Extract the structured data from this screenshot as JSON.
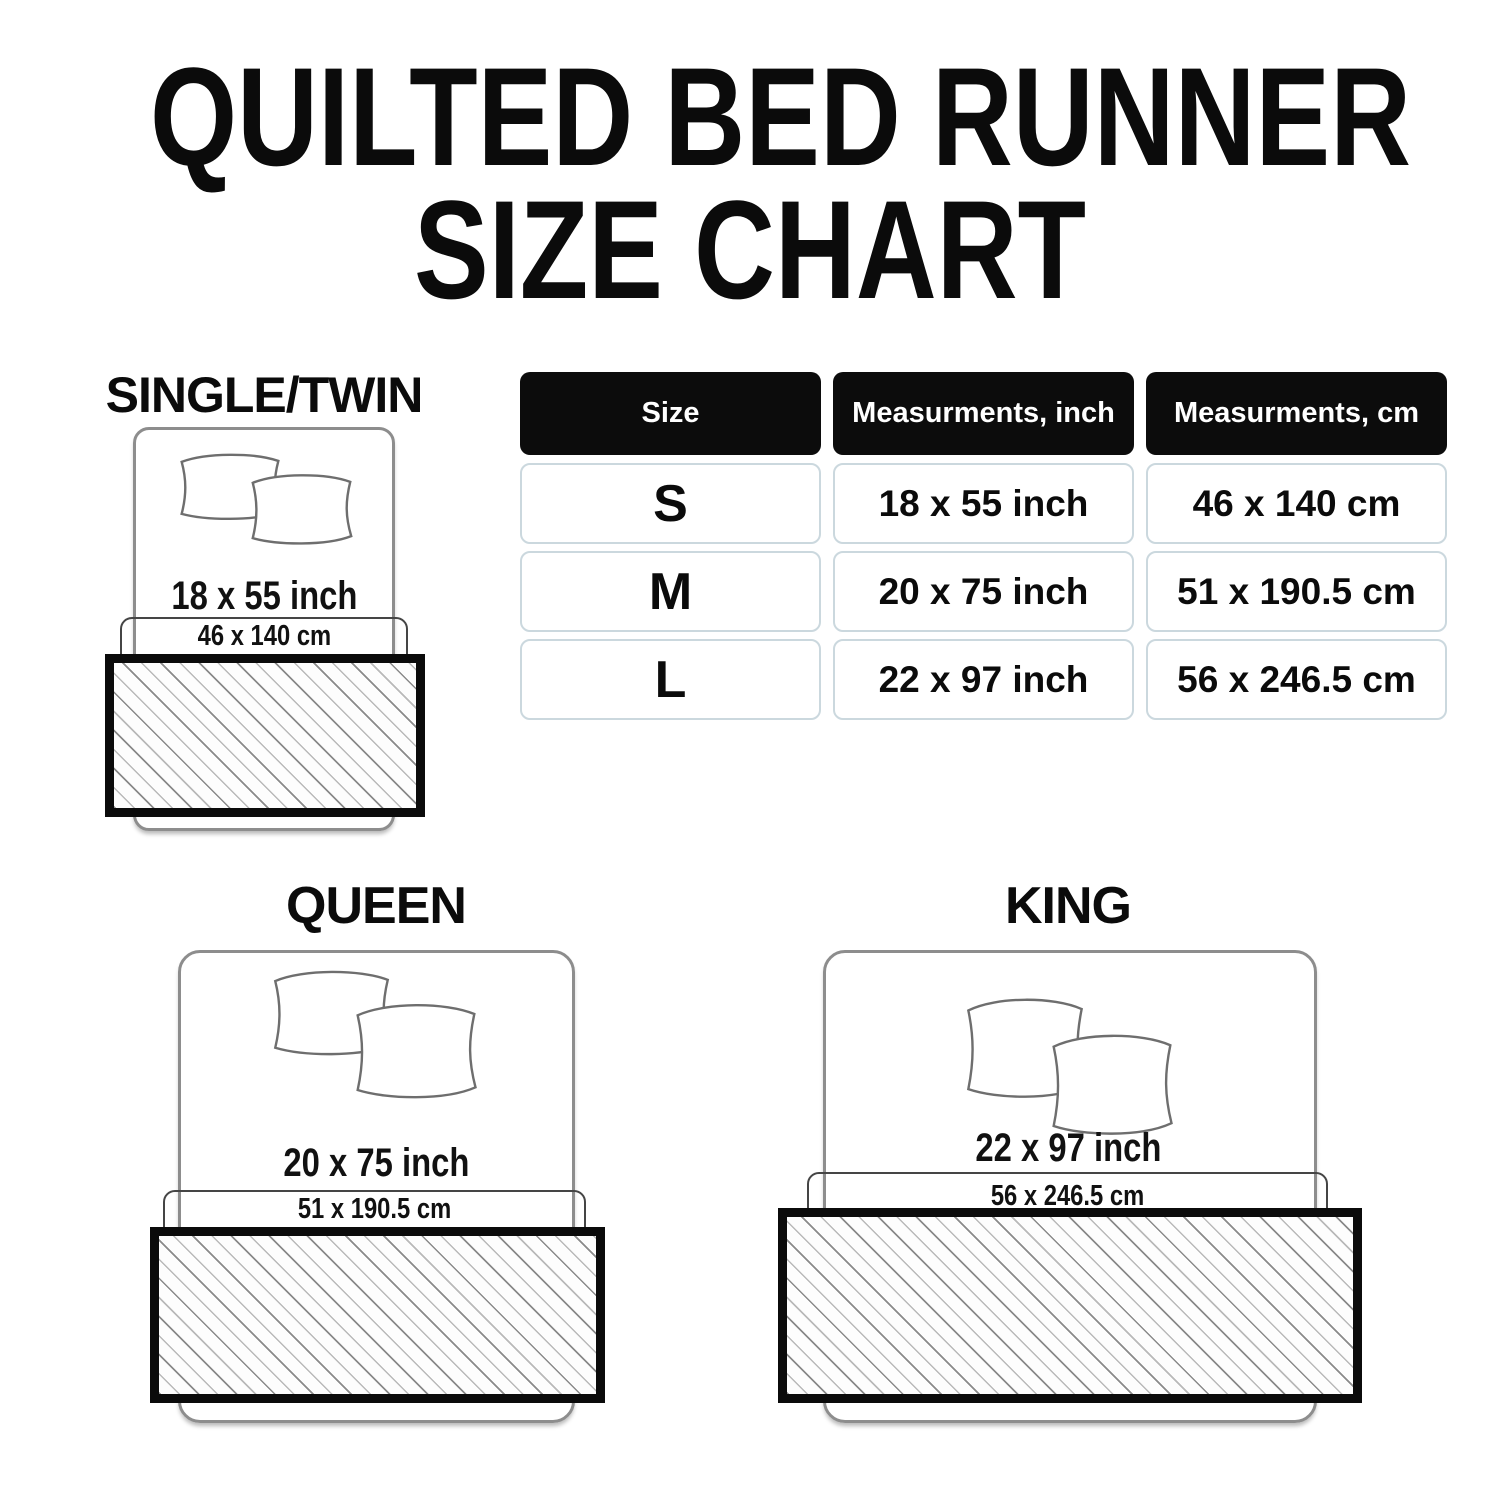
{
  "title": {
    "line1": "QUILTED BED RUNNER",
    "line2": "SIZE CHART"
  },
  "table": {
    "headers": {
      "size": "Size",
      "inch": "Measurments, inch",
      "cm": "Measurments, cm"
    },
    "rows": [
      {
        "size": "S",
        "inch": "18 x 55 inch",
        "cm": "46 x 140 cm"
      },
      {
        "size": "M",
        "inch": "20 x 75 inch",
        "cm": "51 x 190.5 cm"
      },
      {
        "size": "L",
        "inch": "22 x 97 inch",
        "cm": "56 x 246.5 cm"
      }
    ]
  },
  "diagrams": [
    {
      "label": "SINGLE/TWIN",
      "inch": "18 x 55 inch",
      "cm": "46 x 140 cm"
    },
    {
      "label": "QUEEN",
      "inch": "20 x 75 inch",
      "cm": "51 x 190.5 cm"
    },
    {
      "label": "KING",
      "inch": "22 x 97 inch",
      "cm": "56 x 246.5 cm"
    }
  ],
  "colors": {
    "ink": "#0B0B0B",
    "bed_outline": "#8D8D8D",
    "runner_outline": "#454545",
    "table_cell_border": "#CBD8DE",
    "hatch_line": "#8A8A8A"
  },
  "chart_data": {
    "type": "table",
    "title": "QUILTED BED RUNNER SIZE CHART",
    "columns": [
      "Size",
      "Measurments, inch",
      "Measurments, cm"
    ],
    "rows": [
      [
        "S",
        "18 x 55 inch",
        "46 x 140 cm"
      ],
      [
        "M",
        "20 x 75 inch",
        "51 x 190.5 cm"
      ],
      [
        "L",
        "22 x 97 inch",
        "56 x 246.5 cm"
      ]
    ]
  }
}
